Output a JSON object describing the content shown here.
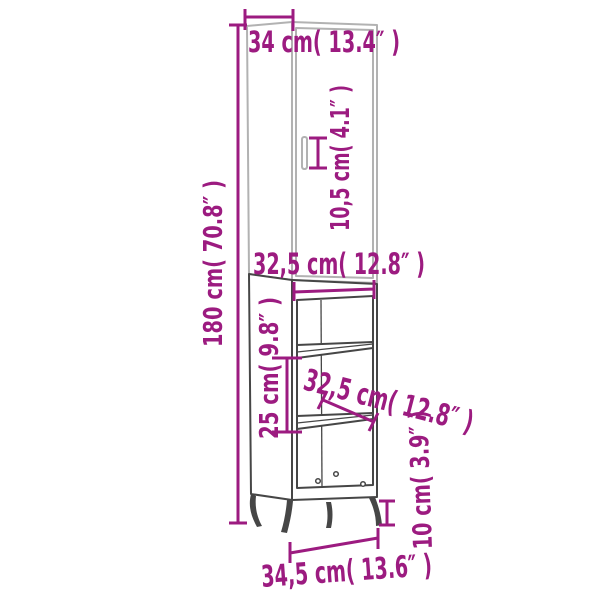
{
  "diagram": {
    "type": "furniture-dimension-diagram",
    "subject": "tall cabinet with door, two open shelves and four legs",
    "colors": {
      "dim": "#9C1B80",
      "upper": "#B2B2B2",
      "lower": "#464646",
      "background": "#FFFFFF"
    },
    "labels": {
      "top_depth": "34 cm( 13.4″ )",
      "handle_length": "10,5 cm( 4.1″ )",
      "total_height": "180 cm( 70.8″ )",
      "inner_width": "32,5 cm( 12.8″ )",
      "compartment_height": "25 cm( 9.8″ )",
      "inner_depth": "32,5 cm( 12.8″ )",
      "leg_height": "10 cm( 3.9″ )",
      "base_width": "34,5 cm( 13.6″ )"
    }
  }
}
